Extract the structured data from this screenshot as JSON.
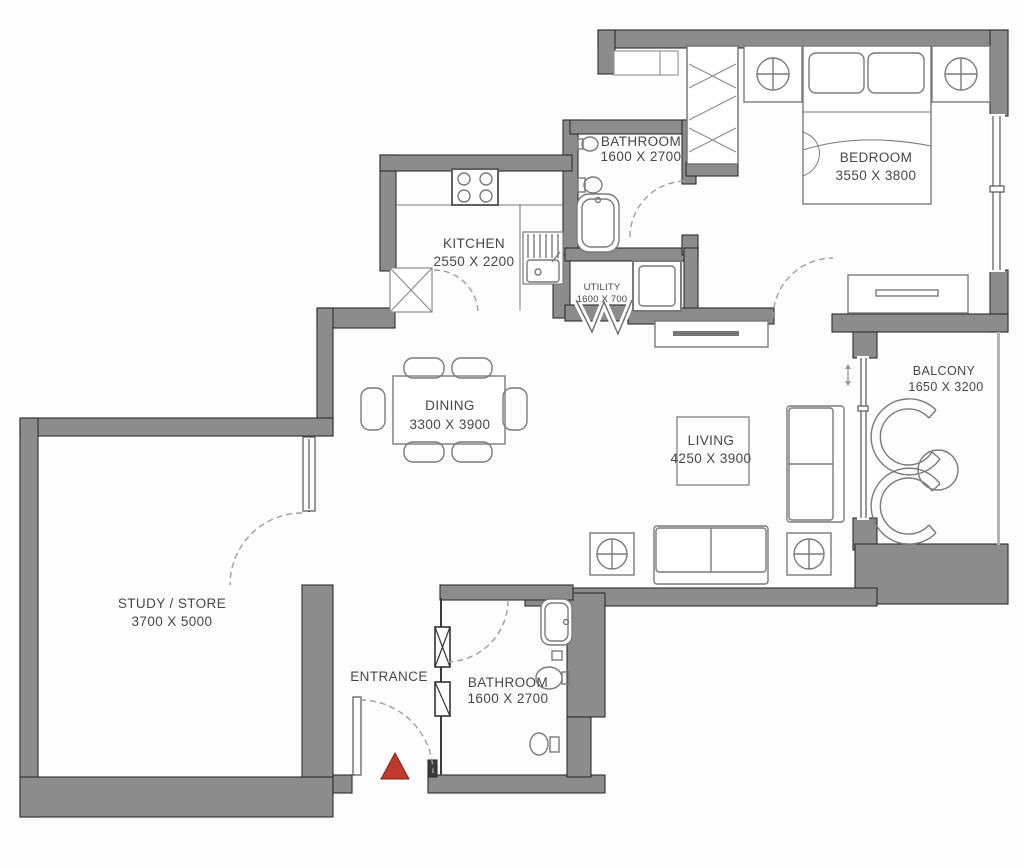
{
  "colors": {
    "wall": "#8c8c8c",
    "wall_light": "#b3b3b3",
    "wall_edge": "#2e2e2e",
    "furniture": "#7a7a7a",
    "door": "#9e9e9e",
    "label": "#474747",
    "entrance_marker": "#c0392b"
  },
  "rooms": {
    "bathroom_top": {
      "label": "BATHROOM",
      "dims": "1600 X 2700"
    },
    "bedroom": {
      "label": "BEDROOM",
      "dims": "3550 X 3800"
    },
    "kitchen": {
      "label": "KITCHEN",
      "dims": "2550 X 2200"
    },
    "utility": {
      "label": "UTILITY",
      "dims": "1600 X 700"
    },
    "dining": {
      "label": "DINING",
      "dims": "3300 X 3900"
    },
    "living": {
      "label": "LIVING",
      "dims": "4250 X 3900"
    },
    "balcony": {
      "label": "BALCONY",
      "dims": "1650 X 3200"
    },
    "study_store": {
      "label": "STUDY / STORE",
      "dims": "3700 X 5000"
    },
    "entrance": {
      "label": "ENTRANCE"
    },
    "bathroom_bottom": {
      "label": "BATHROOM",
      "dims": "1600 X 2700"
    }
  }
}
